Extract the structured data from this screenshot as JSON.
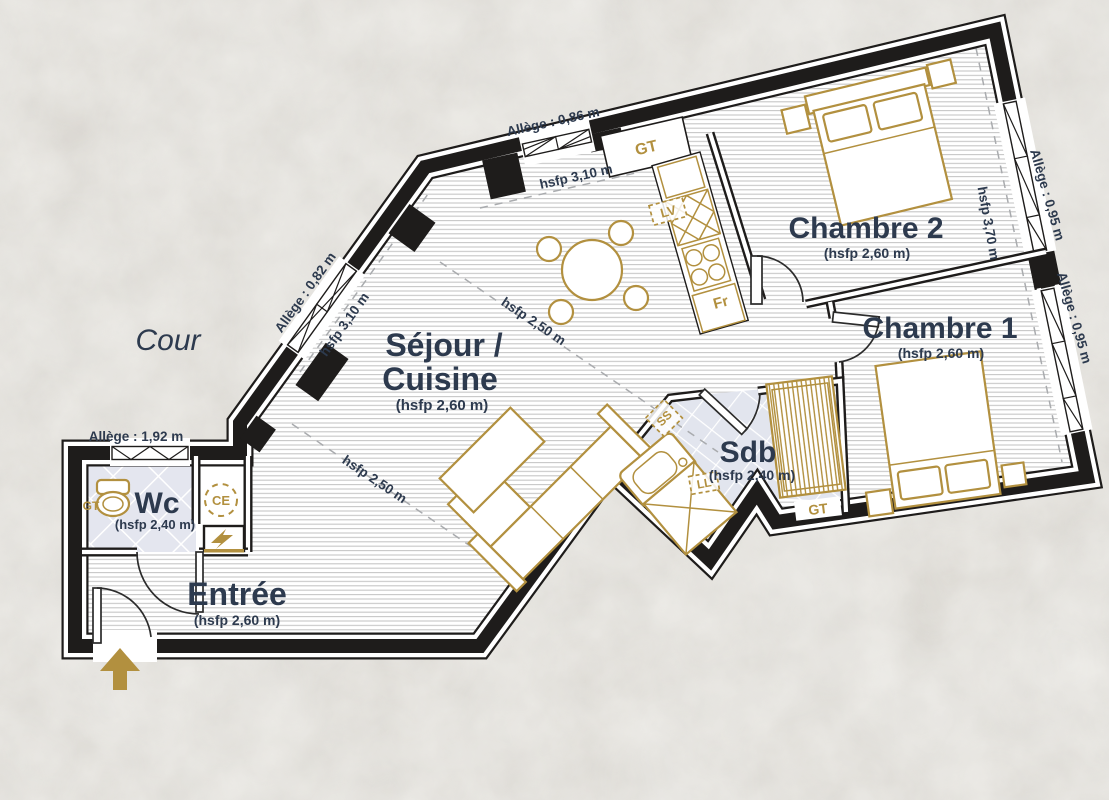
{
  "plan": {
    "outside_label": "Cour"
  },
  "rooms": {
    "sejour_cuisine": {
      "name_line1": "Séjour /",
      "name_line2": "Cuisine",
      "ceiling": "(hsfp 2,60 m)"
    },
    "chambre2": {
      "name": "Chambre 2",
      "ceiling": "(hsfp 2,60 m)"
    },
    "chambre1": {
      "name": "Chambre 1",
      "ceiling": "(hsfp 2,60 m)"
    },
    "sdb": {
      "name": "Sdb",
      "ceiling": "(hsfp 2,40 m)"
    },
    "wc": {
      "name": "Wc",
      "ceiling": "(hsfp 2,40 m)"
    },
    "entree": {
      "name": "Entrée",
      "ceiling": "(hsfp 2,60 m)"
    }
  },
  "window_sills": {
    "top": "Allège : 0,86 m",
    "left": "Allège : 0,82 m",
    "wc": "Allège : 1,92 m",
    "right_upper": "Allège : 0,95 m",
    "right_lower": "Allège : 0,95 m"
  },
  "ceiling_heights": {
    "top": "hsfp 3,10 m",
    "left": "hsfp 3,10 m",
    "right": "hsfp 3,70 m",
    "sejour_upper": "hsfp 2,50 m",
    "sejour_lower": "hsfp 2,50 m"
  },
  "equipment": {
    "gt_closet": "GT",
    "gt_wc": "GT",
    "gt_sdb": "GT",
    "lave_vaisselle": "LV",
    "refrigerateur": "Fr",
    "chauffe_eau": "CE",
    "lave_linge": "LL",
    "seche_serviettes": "SS"
  },
  "colors": {
    "gold": "#b2903f",
    "navy": "#2d3a4e",
    "wall": "#1e1c1b",
    "tile": "#e2e5ee",
    "background": "#d9d6d0"
  }
}
